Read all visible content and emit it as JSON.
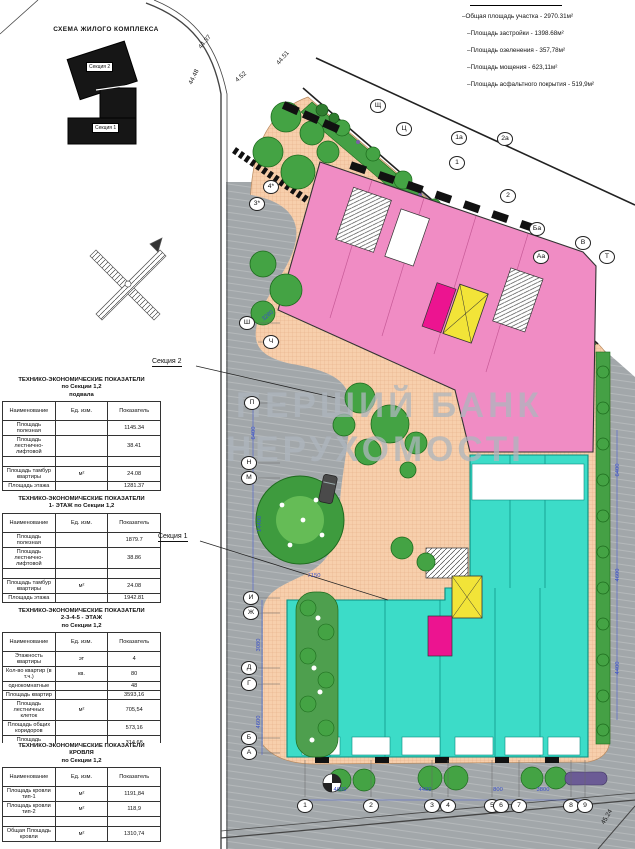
{
  "colors": {
    "pink": "#F08CC4",
    "magenta": "#EC1490",
    "teal": "#3CDCC8",
    "teal_dark": "#0B8D80",
    "yellow": "#F2E438",
    "peach": "#F7CFAC",
    "peach_grid": "#E2AB82",
    "asphalt": "#A2A7AA",
    "green": "#45A045",
    "green_dark": "#1E6B1E",
    "dim_blue": "#3A50C8",
    "watermark": "#ADB6BE"
  },
  "scheme": {
    "title": "СХЕМА ЖИЛОГО КОМПЛЕКСА",
    "section_top_label": "Секция 2",
    "section_bottom_label": "Секция 1"
  },
  "legend": {
    "items": [
      "–Общая площадь участка - 2970.31м²",
      "–Площадь застройки - 1398.68м²",
      "–Площадь озеленения - 357,78м²",
      "–Площадь мощения - 623,11м²",
      "–Площадь асфальтного покрытия - 519,9м²"
    ]
  },
  "tables": [
    {
      "title_lines": [
        "ТЕХНИКО-ЭКОНОМИЧЕСКИЕ ПОКАЗАТЕЛИ",
        "по Секции 1,2",
        "подвала"
      ],
      "headers": [
        "Наименование",
        "Ед. изм.",
        "Показатель"
      ],
      "rows": [
        {
          "name": "Площадь полезная",
          "unit": "",
          "value": "1145.34"
        },
        {
          "name": "Площадь лестнично-лифтовой",
          "unit": "",
          "value": "38.41"
        },
        {
          "name": "",
          "unit": "",
          "value": ""
        },
        {
          "name": "Площадь тамбур квартиры",
          "unit": "м²",
          "value": "24.08"
        },
        {
          "name": "Площадь этажа",
          "unit": "",
          "value": "1281.37"
        }
      ]
    },
    {
      "title_lines": [
        "ТЕХНИКО-ЭКОНОМИЧЕСКИЕ ПОКАЗАТЕЛИ",
        "1- ЭТАЖ по Секции 1,2"
      ],
      "headers": [
        "Наименование",
        "Ед. изм.",
        "Показатель"
      ],
      "rows": [
        {
          "name": "Площадь полезная",
          "unit": "",
          "value": "1879.7"
        },
        {
          "name": "Площадь лестнично-лифтовой",
          "unit": "",
          "value": "38.86"
        },
        {
          "name": "",
          "unit": "",
          "value": ""
        },
        {
          "name": "Площадь тамбур квартиры",
          "unit": "м²",
          "value": "24.08"
        },
        {
          "name": "Площадь этажа",
          "unit": "",
          "value": "1942.81"
        }
      ]
    },
    {
      "title_lines": [
        "ТЕХНИКО-ЭКОНОМИЧЕСКИЕ ПОКАЗАТЕЛИ",
        "2-3-4-5 - ЭТАЖ",
        "по Секции 1,2"
      ],
      "headers": [
        "Наименование",
        "Ед. изм.",
        "Показатель"
      ],
      "rows": [
        {
          "name": "Этажность квартиры",
          "unit": "эт",
          "value": "4"
        },
        {
          "name": "Кол-во квартир (в т.ч.)",
          "unit": "кв.",
          "value": "80"
        },
        {
          "name": "однокомнатные",
          "unit": "",
          "value": "48"
        },
        {
          "name": "Площадь квартир",
          "unit": "",
          "value": "3593,16"
        },
        {
          "name": "Площадь лестничных клеток",
          "unit": "м²",
          "value": "705,54"
        },
        {
          "name": "Площадь общих коридоров",
          "unit": "",
          "value": "573,16"
        },
        {
          "name": "Площадь кладовок",
          "unit": "",
          "value": "314,68"
        },
        {
          "name": "Площадь общая полезная",
          "unit": "",
          "value": "4484,32"
        }
      ]
    },
    {
      "title_lines": [
        "ТЕХНИКО-ЭКОНОМИЧЕСКИЕ ПОКАЗАТЕЛИ",
        "КРОВЛЯ",
        "по Секции 1,2"
      ],
      "headers": [
        "Наименование",
        "Ед. изм.",
        "Показатель"
      ],
      "rows": [
        {
          "name": "Площадь кровли тип-1",
          "unit": "м²",
          "value": "1191,84"
        },
        {
          "name": "Площадь кровли тип-2",
          "unit": "м²",
          "value": "118,9"
        },
        {
          "name": "",
          "unit": "",
          "value": ""
        },
        {
          "name": "Общая Площадь кровли",
          "unit": "м²",
          "value": "1310,74"
        }
      ]
    }
  ],
  "plan": {
    "watermark_line1": "ПЕРШИЙ БАНК",
    "watermark_line2": "НЕРУХОМОСТІ",
    "section1_label": "Секция 1",
    "section2_label": "Секция 2",
    "axis_bubbles": [
      {
        "label": "Щ",
        "x": 378,
        "y": 106
      },
      {
        "label": "Ц",
        "x": 404,
        "y": 129
      },
      {
        "label": "4*",
        "x": 271,
        "y": 187
      },
      {
        "label": "3*",
        "x": 257,
        "y": 204
      },
      {
        "label": "1а",
        "x": 459,
        "y": 138
      },
      {
        "label": "2а",
        "x": 505,
        "y": 139
      },
      {
        "label": "1",
        "x": 457,
        "y": 163
      },
      {
        "label": "2",
        "x": 508,
        "y": 196
      },
      {
        "label": "Ба",
        "x": 537,
        "y": 229
      },
      {
        "label": "Аа",
        "x": 541,
        "y": 257
      },
      {
        "label": "В",
        "x": 583,
        "y": 243
      },
      {
        "label": "Т",
        "x": 607,
        "y": 257
      },
      {
        "label": "Ш",
        "x": 247,
        "y": 323
      },
      {
        "label": "Ч",
        "x": 271,
        "y": 342
      },
      {
        "label": "П",
        "x": 252,
        "y": 403
      },
      {
        "label": "Н",
        "x": 249,
        "y": 463
      },
      {
        "label": "М",
        "x": 249,
        "y": 478
      },
      {
        "label": "И",
        "x": 251,
        "y": 598
      },
      {
        "label": "Ж",
        "x": 251,
        "y": 613
      },
      {
        "label": "Д",
        "x": 249,
        "y": 668
      },
      {
        "label": "Г",
        "x": 249,
        "y": 684
      },
      {
        "label": "Б",
        "x": 249,
        "y": 738
      },
      {
        "label": "А",
        "x": 249,
        "y": 753
      },
      {
        "label": "1",
        "x": 305,
        "y": 806
      },
      {
        "label": "2",
        "x": 371,
        "y": 806
      },
      {
        "label": "3",
        "x": 432,
        "y": 806
      },
      {
        "label": "4",
        "x": 448,
        "y": 806
      },
      {
        "label": "5",
        "x": 492,
        "y": 806
      },
      {
        "label": "6",
        "x": 501,
        "y": 806
      },
      {
        "label": "7",
        "x": 519,
        "y": 806
      },
      {
        "label": "8",
        "x": 571,
        "y": 806
      },
      {
        "label": "9",
        "x": 585,
        "y": 806
      }
    ],
    "dimensions": [
      {
        "text": "3280",
        "x": 268,
        "y": 316,
        "rot": -40
      },
      {
        "text": "6400",
        "x": 254,
        "y": 433,
        "rot": -90
      },
      {
        "text": "14400",
        "x": 260,
        "y": 524,
        "rot": -90
      },
      {
        "text": "7150",
        "x": 314,
        "y": 576,
        "rot": 0
      },
      {
        "text": "3080",
        "x": 259,
        "y": 645,
        "rot": -90
      },
      {
        "text": "4600",
        "x": 259,
        "y": 722,
        "rot": -90
      },
      {
        "text": "4600",
        "x": 340,
        "y": 790,
        "rot": 0
      },
      {
        "text": "4400",
        "x": 425,
        "y": 790,
        "rot": 0
      },
      {
        "text": "800",
        "x": 498,
        "y": 790,
        "rot": 0
      },
      {
        "text": "3800",
        "x": 543,
        "y": 790,
        "rot": 0
      },
      {
        "text": "6400",
        "x": 618,
        "y": 470,
        "rot": -90
      },
      {
        "text": "4600",
        "x": 618,
        "y": 575,
        "rot": -90
      },
      {
        "text": "4400",
        "x": 618,
        "y": 668,
        "rot": -90
      }
    ],
    "elevations": [
      {
        "text": "44.37",
        "x": 205,
        "y": 42,
        "rot": -50
      },
      {
        "text": "44.51",
        "x": 283,
        "y": 58,
        "rot": -50
      },
      {
        "text": "44.48",
        "x": 194,
        "y": 77,
        "rot": -64
      },
      {
        "text": "4.52",
        "x": 241,
        "y": 77,
        "rot": -42
      },
      {
        "text": "45.24",
        "x": 607,
        "y": 817,
        "rot": -60
      }
    ]
  }
}
